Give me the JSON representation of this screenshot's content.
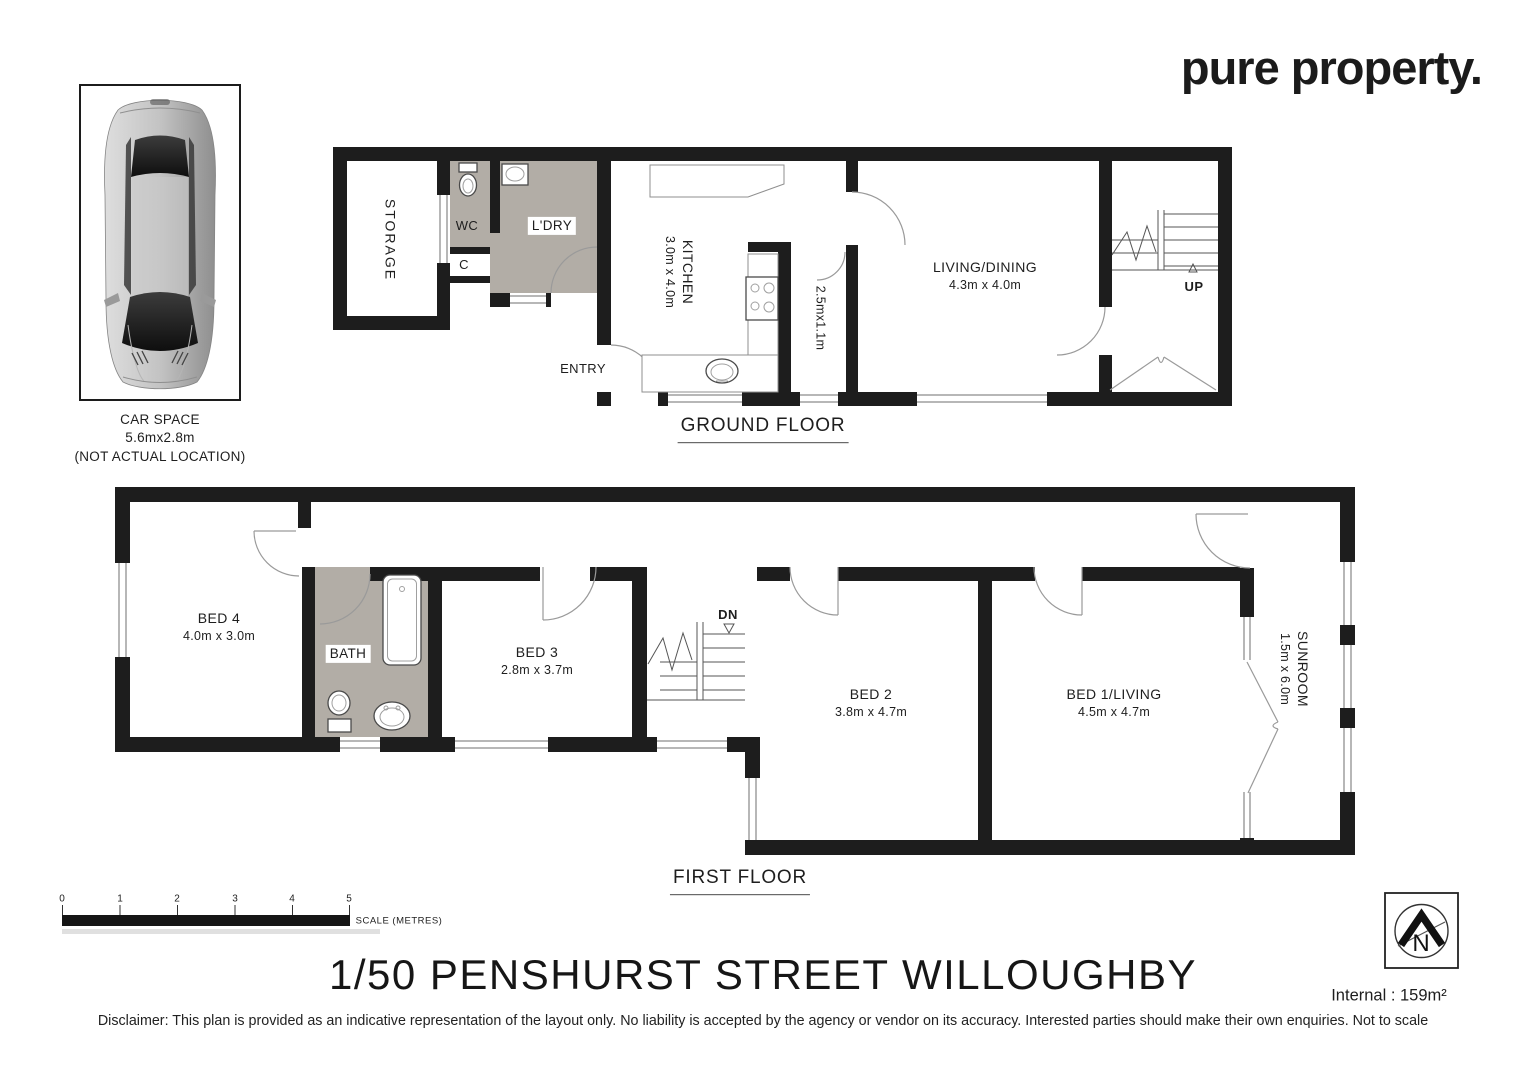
{
  "logo": {
    "text": "pure property."
  },
  "car_space": {
    "title": "CAR SPACE",
    "size": "5.6mx2.8m",
    "note": "(NOT ACTUAL LOCATION)"
  },
  "ground_floor": {
    "label": "GROUND FLOOR",
    "rooms": {
      "storage": {
        "name": "STORAGE"
      },
      "wc": {
        "name": "WC"
      },
      "laundry": {
        "name": "L'DRY"
      },
      "cupboard": {
        "name": "C"
      },
      "entry": {
        "name": "ENTRY"
      },
      "kitchen": {
        "name": "KITCHEN",
        "dims": "3.0m x 4.0m"
      },
      "hall": {
        "dims": "2.5mx1.1m"
      },
      "living_dining": {
        "name": "LIVING/DINING",
        "dims": "4.3m x 4.0m"
      },
      "stairs": {
        "label": "UP"
      }
    }
  },
  "first_floor": {
    "label": "FIRST FLOOR",
    "rooms": {
      "bed4": {
        "name": "BED 4",
        "dims": "4.0m x 3.0m"
      },
      "bath": {
        "name": "BATH"
      },
      "bed3": {
        "name": "BED 3",
        "dims": "2.8m x 3.7m"
      },
      "stairs": {
        "label": "DN"
      },
      "bed2": {
        "name": "BED 2",
        "dims": "3.8m x 4.7m"
      },
      "bed1": {
        "name": "BED 1/LIVING",
        "dims": "4.5m x 4.7m"
      },
      "sunroom": {
        "name": "SUNROOM",
        "dims": "1.5m x 6.0m"
      }
    }
  },
  "scale_bar": {
    "ticks": [
      "0",
      "1",
      "2",
      "3",
      "4",
      "5"
    ],
    "label": "SCALE (METRES)"
  },
  "north": {
    "label": "N"
  },
  "title": "1/50 PENSHURST STREET WILLOUGHBY",
  "internal_area": "Internal : 159m²",
  "disclaimer": "Disclaimer: This plan is provided as an indicative representation of the layout only. No liability is accepted by the agency or vendor on its accuracy. Interested parties should make their own enquiries. Not to scale",
  "colors": {
    "wall": "#1d1d1d",
    "wet_area": "#b2ada6",
    "detail_line": "#8f8f8f"
  }
}
